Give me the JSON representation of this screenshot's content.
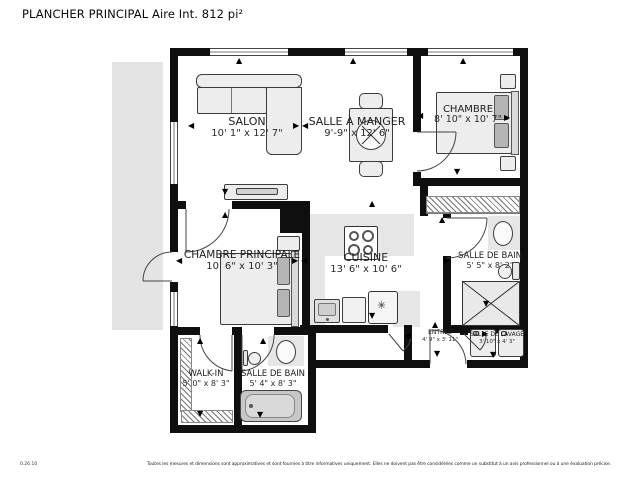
{
  "title": "PLANCHER PRINCIPAL Aire Int. 812 pi²",
  "rooms": {
    "salon": {
      "name": "SALON",
      "dimensions": "10' 1\" x 12' 7\""
    },
    "salle_a_manger": {
      "name": "SALLE À MANGER",
      "dimensions": "9'-9\" x 12' 6\""
    },
    "chambre": {
      "name": "CHAMBRE",
      "dimensions": "8' 10\" x 10' 7\""
    },
    "chambre_principale": {
      "name": "CHAMBRE PRINCIPALE",
      "dimensions": "10' 6\" x 10' 3\""
    },
    "cuisine": {
      "name": "CUISINE",
      "dimensions": "13' 6\" x 10' 6\""
    },
    "salle_de_bain": {
      "name": "SALLE DE BAIN",
      "dimensions": "5' 5\" x 8' 2\""
    },
    "salle_de_lavage": {
      "name": "SALLE DE LAVAGE",
      "dimensions": "3' 10\" x 4' 3\""
    },
    "entree": {
      "name": "ENTRÉE",
      "dimensions": "4' 9\" x 3' 11\""
    },
    "walk_in": {
      "name": "WALK-IN",
      "dimensions": "5' 0\" x 8' 3\""
    },
    "salle_de_bain_2": {
      "name": "SALLE DE BAIN",
      "dimensions": "5' 4\" x 8' 3\""
    }
  },
  "footer": {
    "version": "0.26.10",
    "disclaimer": "Toutes les mesures et dimensions sont approximatives et sont fournies à titre informatives uniquement. Elles ne doivent pas être considérées comme un substitut à un avis professionnel ou à une évaluation précise."
  },
  "icons": {
    "fridge": "snowflake-icon",
    "arrows": "measure-direction-arrow"
  },
  "colors": {
    "wall": "#0f0f0f",
    "balcony": "#e4e4e4",
    "counter": "#e6e6e6",
    "furniture_fill": "#ededed",
    "furniture_stroke": "#3c3c3c",
    "pillow": "#b5b5b5",
    "text": "#1a1a1a"
  }
}
